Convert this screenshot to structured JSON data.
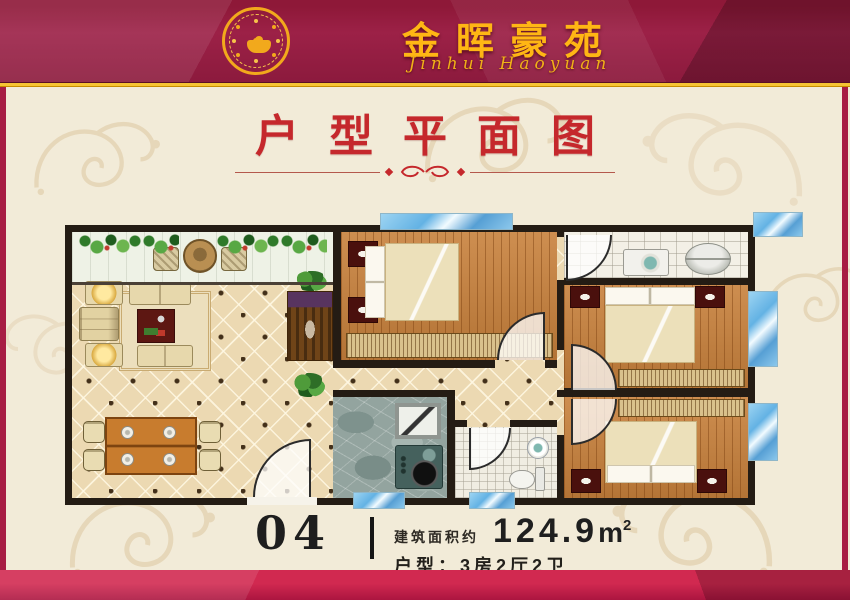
{
  "header": {
    "title": "金晖豪苑",
    "subtitle": "Jinhui Haoyuan",
    "logo": "gold-seal-emblem"
  },
  "section": {
    "title": "户型平面图"
  },
  "unit": {
    "number": "04",
    "area_label": "建筑面积约",
    "area_value": "124.9",
    "area_unit": "m",
    "area_exp": "2",
    "layout_label": "户型：",
    "layout_value": "3房2厅2卫"
  },
  "colors": {
    "banner_red": "#9c2147",
    "gold": "#f2a91c",
    "title_red": "#c5282c",
    "cream": "#f2ebd8",
    "window_blue": "#63b2e4",
    "wall": "#241c14",
    "wood": "#c8813c"
  },
  "floor_plan": {
    "rooms": [
      {
        "name": "balcony"
      },
      {
        "name": "living-room"
      },
      {
        "name": "dining-area"
      },
      {
        "name": "kitchen"
      },
      {
        "name": "master-bedroom"
      },
      {
        "name": "bedroom-2"
      },
      {
        "name": "bedroom-3"
      },
      {
        "name": "bathroom"
      },
      {
        "name": "laundry-room"
      }
    ]
  }
}
